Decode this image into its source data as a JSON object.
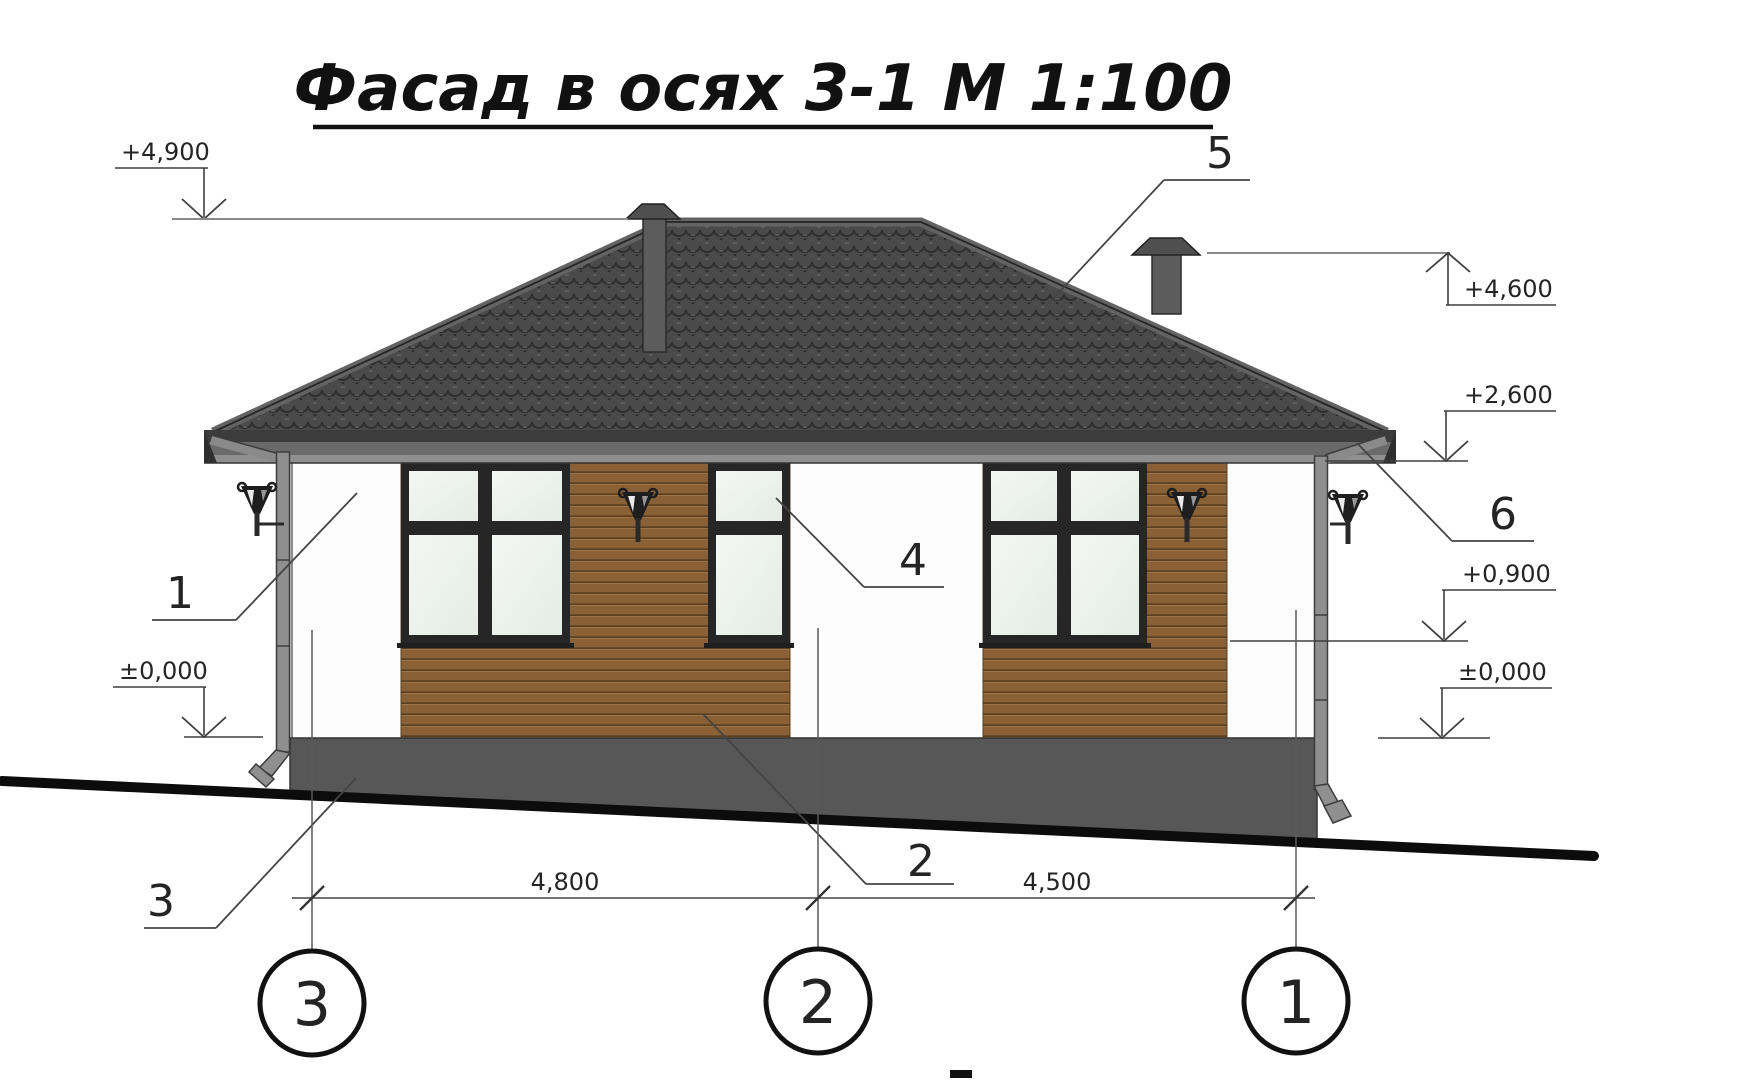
{
  "title": "Фасад в осях 3-1 М 1:100",
  "elevation_marks": [
    {
      "label": "+4,900",
      "side": "left"
    },
    {
      "label": "+4,600",
      "side": "right"
    },
    {
      "label": "+2,600",
      "side": "right"
    },
    {
      "label": "+0,900",
      "side": "right"
    },
    {
      "label": "±0,000",
      "side": "right"
    },
    {
      "label": "±0,000",
      "side": "left"
    }
  ],
  "callouts": [
    {
      "number": "1"
    },
    {
      "number": "2"
    },
    {
      "number": "3"
    },
    {
      "number": "4"
    },
    {
      "number": "5"
    },
    {
      "number": "6"
    }
  ],
  "dimensions": [
    {
      "label": "4,800"
    },
    {
      "label": "4,500"
    }
  ],
  "axes": [
    {
      "label": "3"
    },
    {
      "label": "2"
    },
    {
      "label": "1"
    }
  ],
  "colors": {
    "roof_tiles": "#4a4a4a",
    "ridge_cap": "#636363",
    "fascia": "#6a6a6a",
    "wall": "#fcfcfc",
    "wood_siding": "#8a6136",
    "window_frame": "#262626",
    "glass": "#edf3ed",
    "plinth": "#575757",
    "ground": "#0c0c0c",
    "annotation": "#3f3f3f"
  }
}
